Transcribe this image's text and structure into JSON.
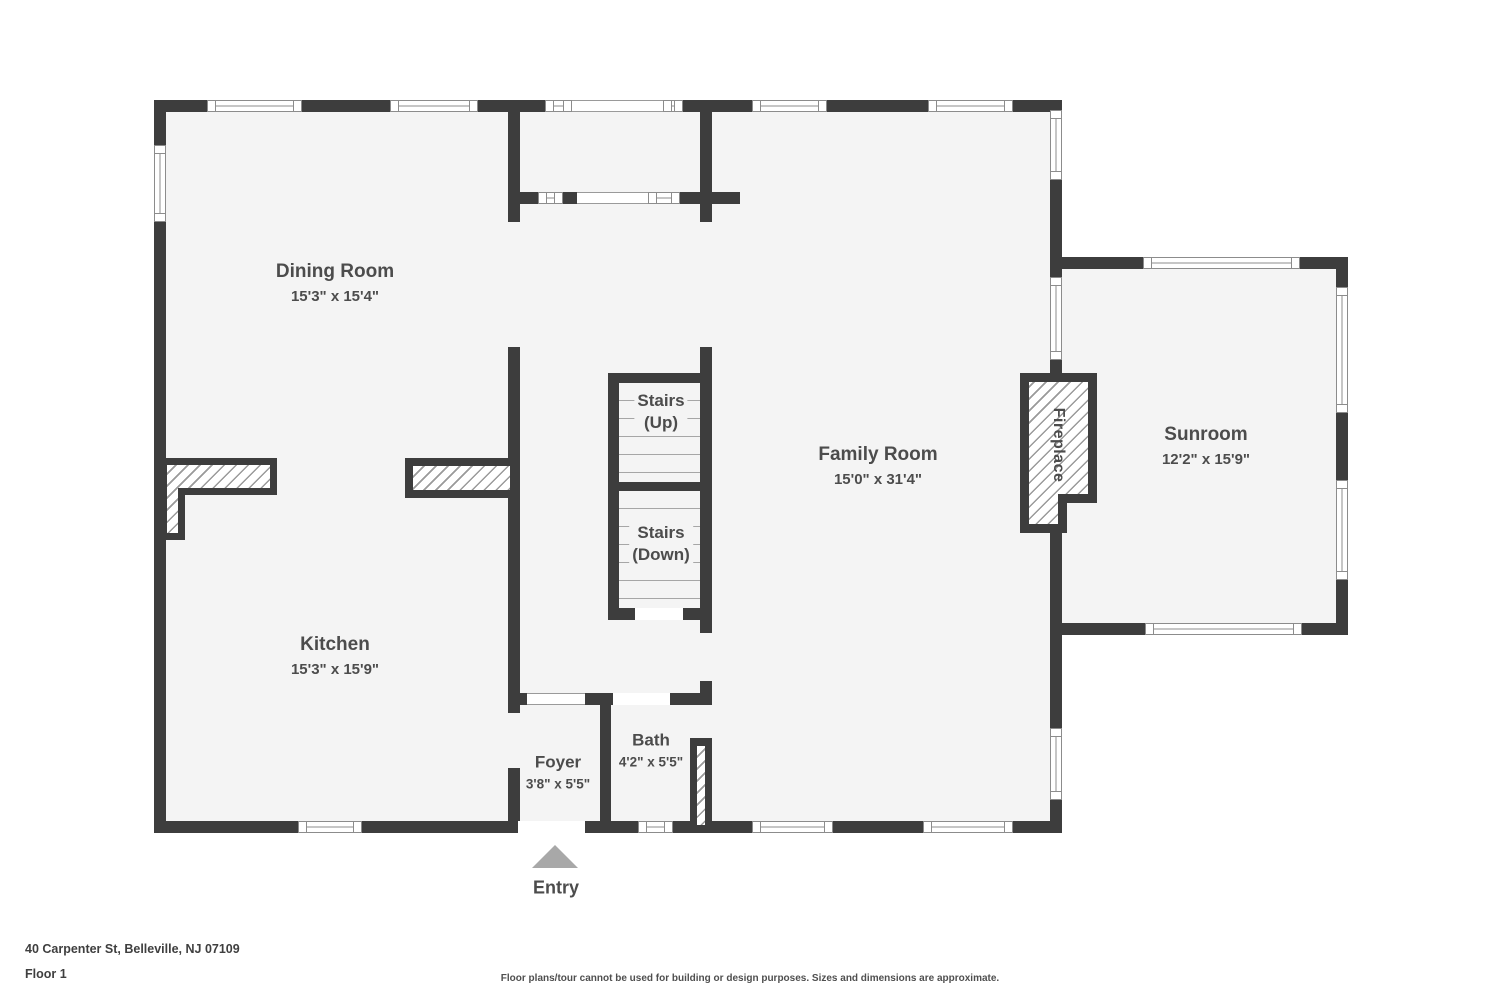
{
  "colors": {
    "wall": "#3d3d3d",
    "floor": "#f4f4f4",
    "window_border": "#8c8c8c",
    "text": "#4c4c4c",
    "entry_arrow": "#a8a8a8"
  },
  "rooms": {
    "dining": {
      "name": "Dining Room",
      "dims": "15'3\" x 15'4\""
    },
    "kitchen": {
      "name": "Kitchen",
      "dims": "15'3\" x 15'9\""
    },
    "family": {
      "name": "Family Room",
      "dims": "15'0\" x 31'4\""
    },
    "sunroom": {
      "name": "Sunroom",
      "dims": "12'2\" x 15'9\""
    },
    "foyer": {
      "name": "Foyer",
      "dims": "3'8\" x 5'5\""
    },
    "bath": {
      "name": "Bath",
      "dims": "4'2\" x 5'5\""
    },
    "stairs_up": {
      "line1": "Stairs",
      "line2": "(Up)"
    },
    "stairs_down": {
      "line1": "Stairs",
      "line2": "(Down)"
    },
    "fireplace": {
      "name": "Fireplace"
    }
  },
  "entry": {
    "label": "Entry"
  },
  "footer": {
    "address": "40 Carpenter St, Belleville, NJ 07109",
    "floor": "Floor 1",
    "disclaimer": "Floor plans/tour cannot be used for building or design purposes. Sizes and dimensions are approximate."
  }
}
